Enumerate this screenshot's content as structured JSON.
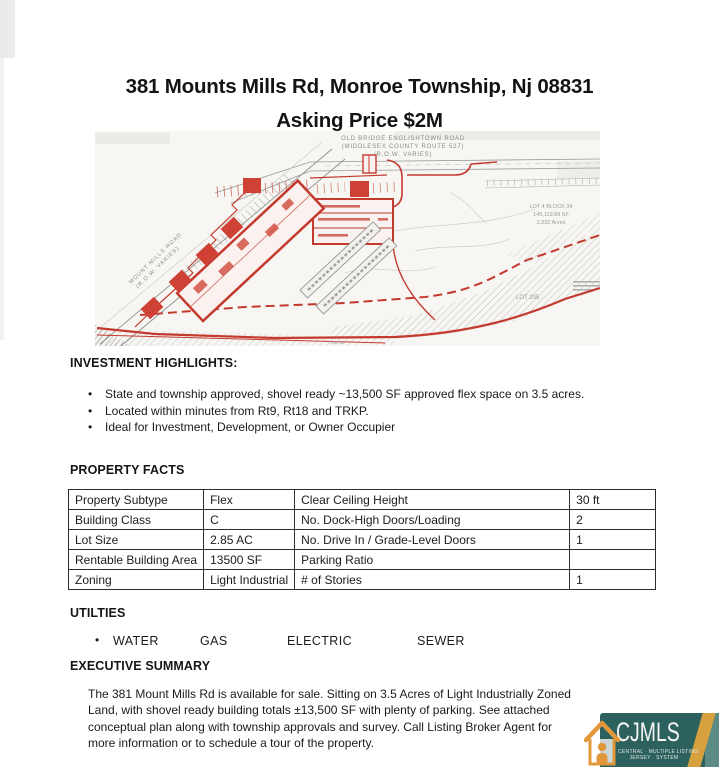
{
  "header": {
    "title_line1": "381 Mounts Mills Rd, Monroe Township, Nj 08831",
    "title_line2": "Asking Price $2M"
  },
  "site_plan": {
    "top_road_line1": "OLD BRIDGE ENGLISHTOWN ROAD",
    "top_road_line2": "(MIDDLESEX COUNTY ROUTE 527)",
    "top_road_line3": "(R.O.W. VARIES)",
    "left_road_line1": "MOUNT MILLS ROAD",
    "left_road_line2": "(R.O.W. VARIES)",
    "lot4_line1": "LOT 4 BLOCK 34",
    "lot4_line2": "145,119.89 SF",
    "lot4_line3": "3.332 Acres",
    "lot205": "LOT 205",
    "dim_label": "140.50'"
  },
  "highlights": {
    "heading": "INVESTMENT HIGHLIGHTS:",
    "bullets": [
      "State and township approved, shovel ready ~13,500 SF approved flex space on 3.5 acres.",
      "Located within minutes from Rt9, Rt18 and TRKP.",
      "Ideal for Investment, Development, or Owner Occupier"
    ]
  },
  "property_facts": {
    "heading": "PROPERTY FACTS",
    "rows": [
      {
        "label_left": "Property Subtype",
        "value_left": "Flex",
        "label_right": "Clear Ceiling Height",
        "value_right": "30 ft"
      },
      {
        "label_left": "Building Class",
        "value_left": "C",
        "label_right": "No. Dock-High Doors/Loading",
        "value_right": "2"
      },
      {
        "label_left": "Lot Size",
        "value_left": "2.85 AC",
        "label_right": "No. Drive In / Grade-Level Doors",
        "value_right": "1"
      },
      {
        "label_left": "Rentable Building Area",
        "value_left": "13500 SF",
        "label_right": "Parking Ratio",
        "value_right": ""
      },
      {
        "label_left": "Zoning",
        "value_left": "Light Industrial",
        "label_right": "# of Stories",
        "value_right": "1"
      }
    ]
  },
  "utilities": {
    "heading": "UTILTIES",
    "items": [
      "WATER",
      "GAS",
      "ELECTRIC",
      "SEWER"
    ]
  },
  "executive": {
    "heading": "EXECUTIVE SUMMARY",
    "lines": [
      "The 381 Mount Mills Rd is available for sale. Sitting on 3.5 Acres of Light Industrially Zoned",
      "Land, with shovel ready building totals ±13,500 SF with plenty of parking. See attached",
      "conceptual plan along with township approvals and survey. Call Listing Broker Agent for",
      "more information or to schedule a tour of the property."
    ]
  },
  "logo": {
    "name": "CJMLS",
    "subtitle_line1": "CENTRAL · MULTIPLE LISTING",
    "subtitle_line2": "JERSEY · SYSTEM",
    "colors": {
      "teal": "#2d615e",
      "teal_light": "#5c8b85",
      "gold": "#d8a13f",
      "orange": "#e2973b"
    }
  }
}
